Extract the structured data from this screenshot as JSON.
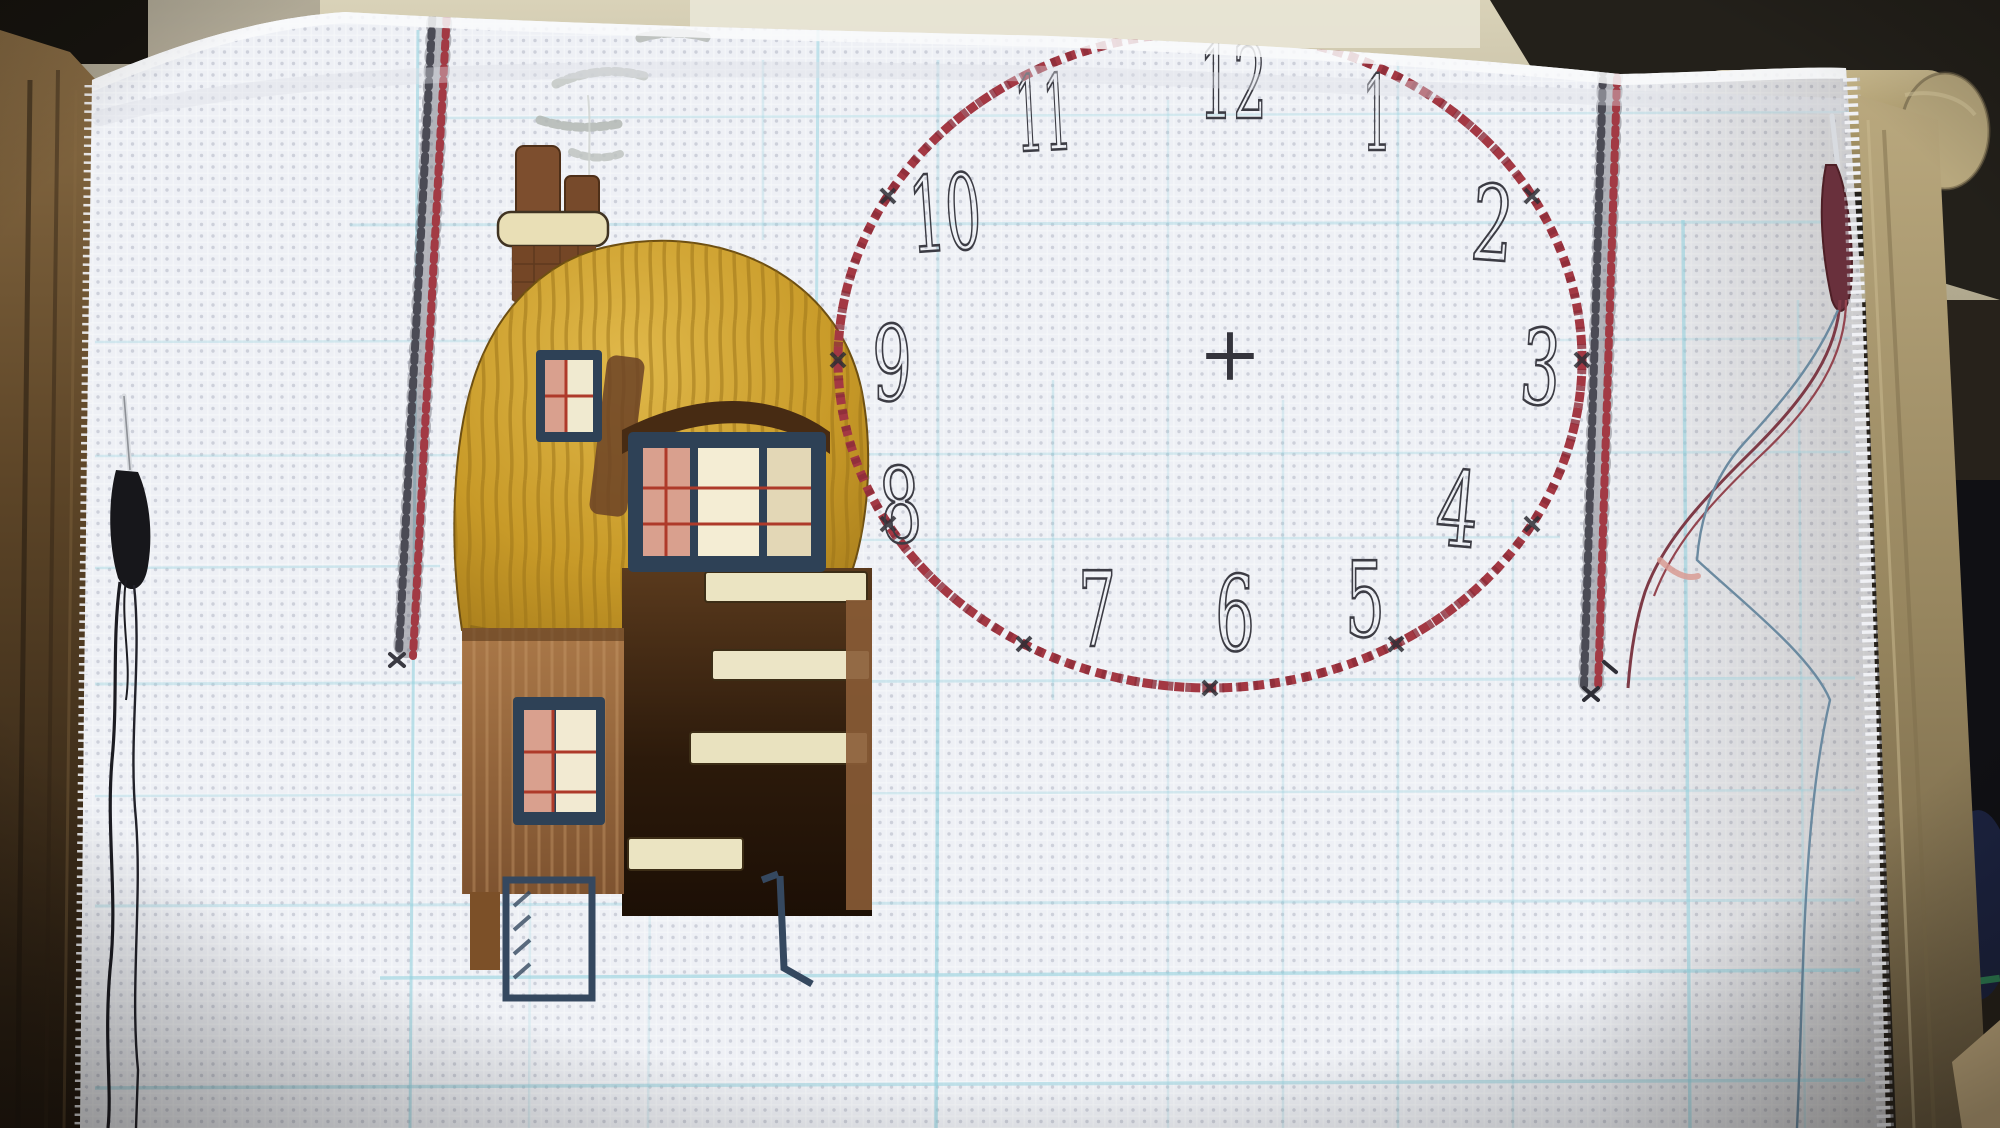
{
  "scene": {
    "kind": "photograph",
    "subject": "cross-stitch sampler in progress on a wooden scroll frame"
  },
  "clock": {
    "numerals": {
      "h1": "1",
      "h2": "2",
      "h3": "3",
      "h4": "4",
      "h5": "5",
      "h6": "6",
      "h7": "7",
      "h8": "8",
      "h9": "9",
      "h10": "10",
      "h11": "11",
      "h12": "12"
    },
    "center_mark": "+"
  },
  "palette": {
    "fabric_white": "#edeff4",
    "grid_blue": "#8fd0dd",
    "border_stitch_red": "#a23a44",
    "border_stitch_black": "#4b4b55",
    "clock_circle_red": "#a33843",
    "numeral_ink": "#3c3c44",
    "thatch_gold": "#c89a28",
    "house_brown": "#8a5a34",
    "window_navy": "#2e4156",
    "mullion_red": "#ae3a2a",
    "step_cream": "#ebe4c2",
    "smoke_grey": "#b9beba",
    "wood_dark": "#4a3621",
    "wood_light": "#a8976f",
    "thread_black": "#1a1a1f",
    "thread_maroon": "#7d3a46",
    "thread_blue": "#6b8aa0",
    "wall_tan": "#c9c2a6"
  },
  "objects": {
    "fabric": "gridded aida cloth",
    "left_column": "black and red railroad border stitching",
    "right_column": "black and red railroad border stitching",
    "cottage": "thatched cottage cross-stitch motif",
    "clock_face": "red stitched clock circle with printed numerals",
    "left_needle": "needle parked with black thread",
    "right_needle": "needle parked with maroon thread",
    "frame": "wooden scroll frame bars and dowel"
  }
}
